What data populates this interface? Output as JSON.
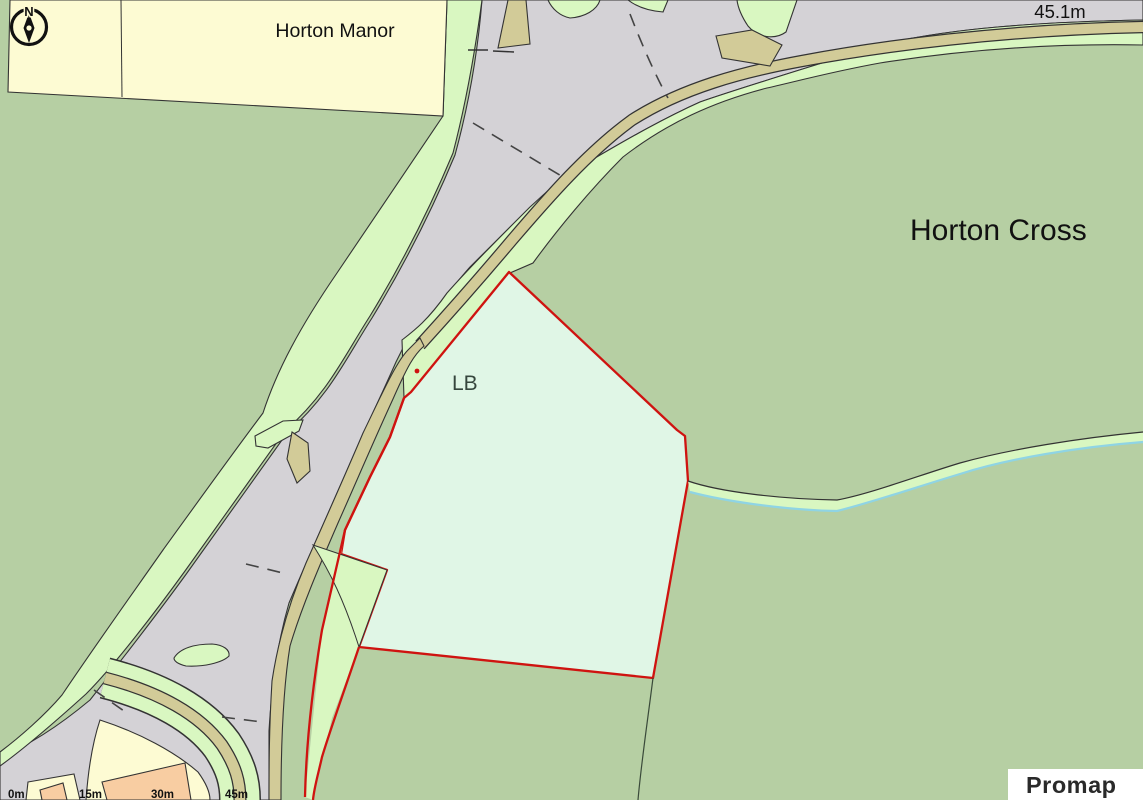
{
  "map": {
    "labels": {
      "manor": "Horton Manor",
      "spot_height": "45.1m",
      "area": "Horton Cross",
      "letter_box": "LB"
    },
    "compass": {
      "north": "N"
    },
    "scale": {
      "labels": [
        "0m",
        "15m",
        "30m",
        "45m"
      ]
    },
    "branding": {
      "logo": "Promap"
    },
    "colors": {
      "field_green": "#b6cfa3",
      "verge_green": "#d9f7c1",
      "road_gray": "#d4d2d6",
      "track_tan": "#d2cb98",
      "parcel_mint": "#e0f6e6",
      "boundary_red": "#cf1310",
      "parcel_cream": "#fdfbd3",
      "building_orange": "#f8cda2",
      "stream_cyan": "#8fd4e4"
    }
  }
}
